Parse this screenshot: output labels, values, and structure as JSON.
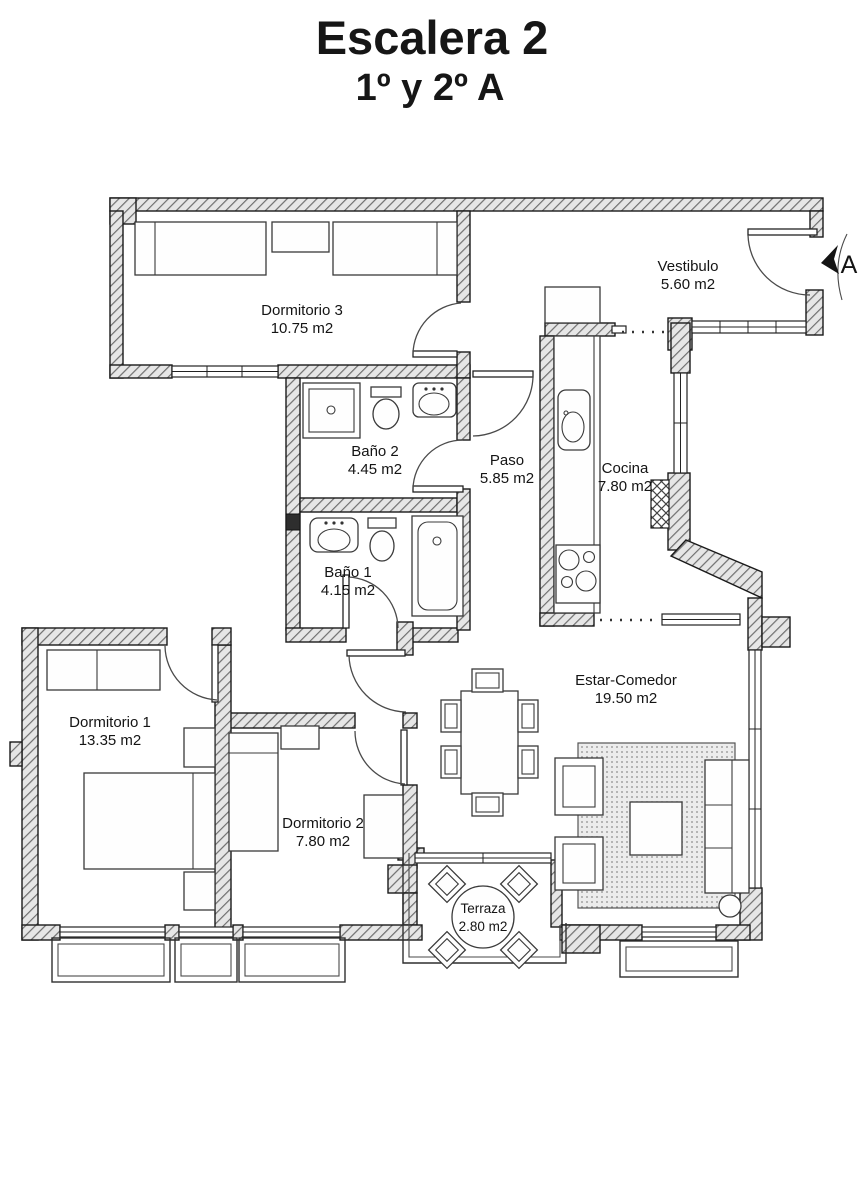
{
  "title": "Escalera 2",
  "subtitle": "1º y 2º A",
  "entrance": {
    "label": "A",
    "icon": "entrance-arrow"
  },
  "rooms": [
    {
      "id": "dormitorio-3",
      "name": "Dormitorio 3",
      "area": "10.75 m2"
    },
    {
      "id": "vestibulo",
      "name": "Vestibulo",
      "area": "5.60 m2"
    },
    {
      "id": "bano-2",
      "name": "Baño 2",
      "area": "4.45 m2"
    },
    {
      "id": "paso",
      "name": "Paso",
      "area": "5.85 m2"
    },
    {
      "id": "cocina",
      "name": "Cocina",
      "area": "7.80 m2"
    },
    {
      "id": "bano-1",
      "name": "Baño 1",
      "area": "4.15 m2"
    },
    {
      "id": "dormitorio-1",
      "name": "Dormitorio 1",
      "area": "13.35 m2"
    },
    {
      "id": "dormitorio-2",
      "name": "Dormitorio 2",
      "area": "7.80 m2"
    },
    {
      "id": "estar-comedor",
      "name": "Estar-Comedor",
      "area": "19.50 m2"
    },
    {
      "id": "terraza",
      "name": "Terraza",
      "area": "2.80 m2"
    }
  ],
  "colors": {
    "background": "#ffffff",
    "wall_hatch": "#6f6f6f",
    "wall_fill": "#e6e6e6",
    "outline": "#1a1a1a",
    "text": "#141414"
  }
}
